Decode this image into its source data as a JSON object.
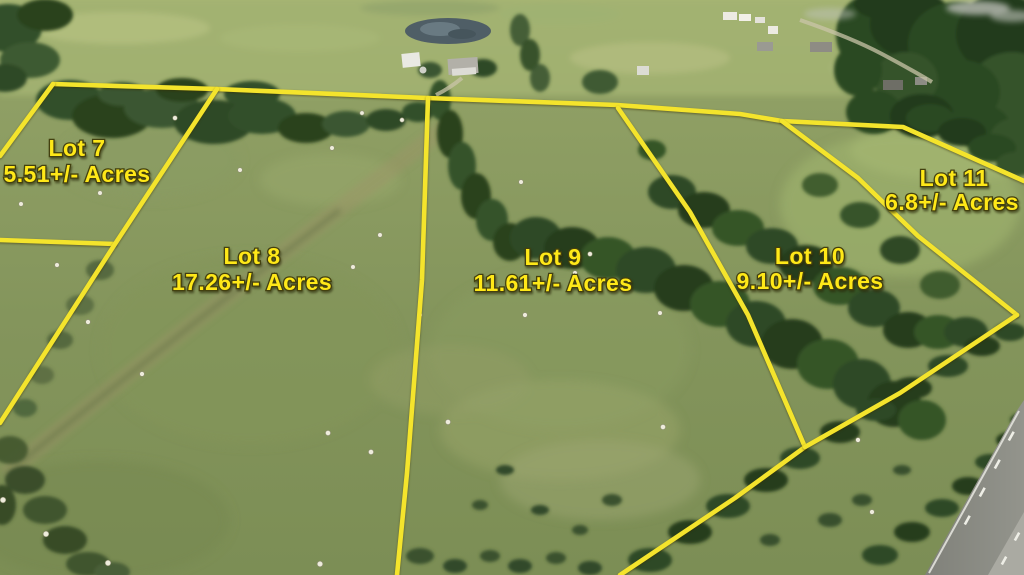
{
  "lots": [
    {
      "name": "Lot 7",
      "acreage": "5.51+/- Acres"
    },
    {
      "name": "Lot 8",
      "acreage": "17.26+/- Acres"
    },
    {
      "name": "Lot 9",
      "acreage": "11.61+/- Acres"
    },
    {
      "name": "Lot 10",
      "acreage": "9.10+/- Acres"
    },
    {
      "name": "Lot 11",
      "acreage": "6.8+/- Acres"
    }
  ],
  "colors": {
    "boundary_line": "#f4e42c",
    "label_text": "#ffe818",
    "label_outline": "#43400f"
  }
}
